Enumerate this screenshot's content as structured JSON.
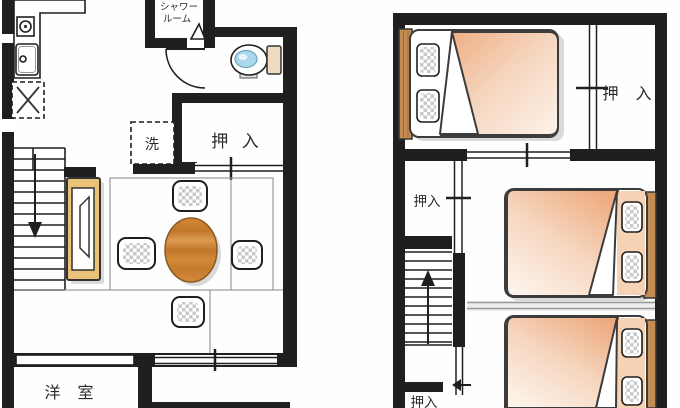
{
  "meta": {
    "document_type": "residential floor plan, two stories side by side",
    "floor_left": "first floor",
    "floor_right": "second floor"
  },
  "colors": {
    "wall": "#1f1f1f",
    "floor_line": "#888888",
    "text": "#2b2b2b",
    "table_wood": "#d28a38",
    "table_wood_dark": "#c1762a",
    "cabinet_wood": "#e9c179",
    "headboard_wood": "#c28b52",
    "blanket_peach": "#edaa7d",
    "blanket_fade": "#fdf3ea",
    "pillow_check": "#c9c9c9",
    "toilet_water": "#a9d8ec",
    "toilet_tank": "#eedabf"
  },
  "floor1": {
    "labels": {
      "shower_line1": "シャワー",
      "shower_line2": "ルーム",
      "closet": "押 入",
      "washer": "洗",
      "western_room": "洋 室"
    },
    "fixtures": [
      "stove",
      "kitchen-sink",
      "refrigerator-space",
      "washing-machine-space",
      "toilet",
      "shower-room",
      "closet",
      "staircase-down",
      "tv-cabinet",
      "round-dining-table",
      "chair",
      "chair",
      "chair",
      "chair"
    ]
  },
  "floor2": {
    "labels": {
      "closet_top_right": "押 入",
      "closet_mid_left": "押入",
      "closet_bottom_left": "押入"
    },
    "fixtures": [
      "double-bed",
      "double-bed",
      "double-bed",
      "closet",
      "closet",
      "closet",
      "staircase-up"
    ]
  }
}
